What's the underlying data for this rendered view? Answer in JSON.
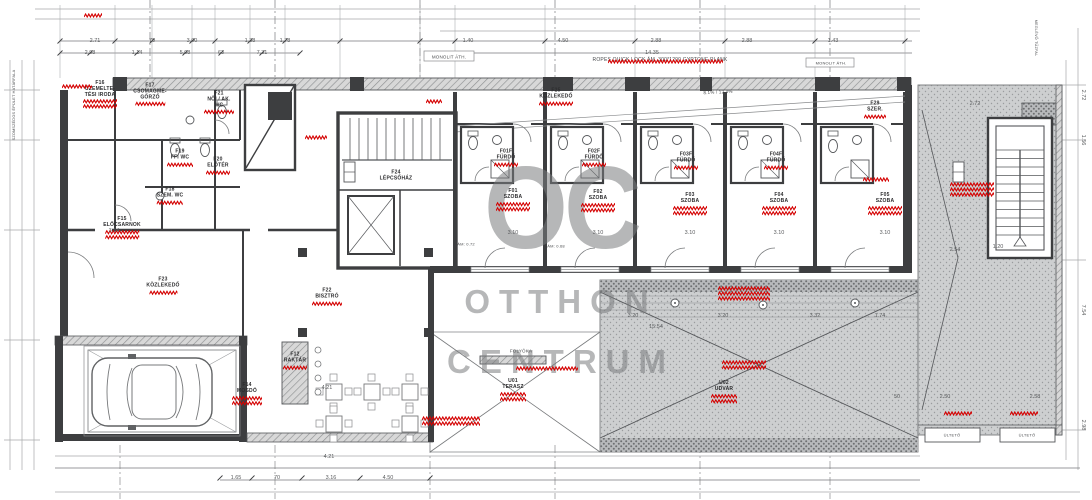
{
  "watermark": {
    "initials": "OC",
    "line1": "OTTHON",
    "line2": "CENTRUM"
  },
  "colors": {
    "wall": "#3d3e40",
    "line_medium": "#77797b",
    "line_light": "#a6a8aa",
    "redaction": "#d40000",
    "hatch_gray": "#d8d8d8",
    "stipple_gray": "#cdcfd0",
    "watermark_gray": "#7a7c7e"
  },
  "notes": [
    {
      "text": "MONOLIT ÁTH.",
      "x": 449,
      "y": 57,
      "size": 4.5,
      "rot": 0
    },
    {
      "text": "ROPES QUICK LOCK ÁM. 300*1200 GYPTONE PLANK",
      "x": 660,
      "y": 60,
      "size": 5,
      "rot": 0
    },
    {
      "text": "MONOLIT ÁTH.",
      "x": 831,
      "y": 63,
      "size": 4,
      "rot": 0
    },
    {
      "text": "8.1% / 12.4%",
      "x": 718,
      "y": 92,
      "size": 4.5,
      "rot": -3
    },
    {
      "text": "FOLYÓKA",
      "x": 521,
      "y": 351,
      "size": 4.5,
      "rot": 0
    },
    {
      "text": "ÜLTETŐ",
      "x": 952,
      "y": 435,
      "size": 4,
      "rot": 0
    },
    {
      "text": "ÜLTETŐ",
      "x": 1027,
      "y": 435,
      "size": 4,
      "rot": 0
    },
    {
      "text": "ÁM: 0.72",
      "x": 466,
      "y": 244,
      "size": 4,
      "rot": 0
    },
    {
      "text": "ÁM: 0.68",
      "x": 556,
      "y": 246,
      "size": 4,
      "rot": 0
    },
    {
      "text": "SZOMSZÉDOS ÉPÜLET HATÁRFALA",
      "x": 14,
      "y": 105,
      "size": 3.8,
      "rot": -90
    },
    {
      "text": "MEGLÉVŐ TŰZFAL",
      "x": 1036,
      "y": 38,
      "size": 3.8,
      "rot": 90
    }
  ],
  "rooms": [
    {
      "lines": [
        "F16",
        "ÜZEMELTE-",
        "TÉSI IRODA"
      ],
      "x": 100,
      "y": 95,
      "red": [
        34,
        2
      ]
    },
    {
      "lines": [
        "F17",
        "CSOMAGME-",
        "GŐRZŐ"
      ],
      "x": 150,
      "y": 95,
      "red": [
        30,
        1
      ]
    },
    {
      "lines": [
        "F21",
        "NŐI / AK.",
        "WC"
      ],
      "x": 219,
      "y": 103,
      "red": [
        30,
        1
      ]
    },
    {
      "lines": [
        "F19",
        "FFI WC"
      ],
      "x": 180,
      "y": 158,
      "red": [
        26,
        1
      ]
    },
    {
      "lines": [
        "F20",
        "ELŐTÉR"
      ],
      "x": 218,
      "y": 166,
      "red": [
        24,
        1
      ]
    },
    {
      "lines": [
        "F18",
        "SZEM. WC"
      ],
      "x": 170,
      "y": 196,
      "red": [
        26,
        1
      ]
    },
    {
      "lines": [
        "F15",
        "ELŐCSARNOK"
      ],
      "x": 122,
      "y": 228,
      "red": [
        34,
        2
      ]
    },
    {
      "lines": [
        "F23",
        "KÖZLEKEDŐ"
      ],
      "x": 163,
      "y": 286,
      "red": [
        28,
        1
      ]
    },
    {
      "lines": [
        "F22",
        "BISZTRÓ"
      ],
      "x": 327,
      "y": 297,
      "red": [
        30,
        1
      ]
    },
    {
      "lines": [
        "F12",
        "RAKTÁR"
      ],
      "x": 295,
      "y": 361,
      "red": [
        24,
        1
      ]
    },
    {
      "lines": [
        "F14",
        "MOSDÓ"
      ],
      "x": 247,
      "y": 394,
      "red": [
        30,
        2
      ]
    },
    {
      "lines": [
        "F24",
        "LÉPCSŐHÁZ"
      ],
      "x": 396,
      "y": 176,
      "red": null
    },
    {
      "lines": [
        "F25",
        "KÖZLEKEDŐ"
      ],
      "x": 556,
      "y": 97,
      "red": [
        34,
        1
      ]
    },
    {
      "lines": [
        "F29",
        "SZER."
      ],
      "x": 875,
      "y": 110,
      "red": [
        22,
        1
      ]
    },
    {
      "lines": [
        "F01F",
        "FÜRDŐ"
      ],
      "x": 506,
      "y": 158,
      "red": [
        24,
        1
      ]
    },
    {
      "lines": [
        "F02F",
        "FÜRDŐ"
      ],
      "x": 594,
      "y": 158,
      "red": [
        24,
        1
      ]
    },
    {
      "lines": [
        "F03F",
        "FÜRDŐ"
      ],
      "x": 686,
      "y": 161,
      "red": [
        24,
        1
      ]
    },
    {
      "lines": [
        "F04F",
        "FÜRDŐ"
      ],
      "x": 776,
      "y": 161,
      "red": [
        24,
        1
      ]
    },
    {
      "lines": [
        "F01",
        "SZOBA"
      ],
      "x": 513,
      "y": 200,
      "red": [
        34,
        2
      ]
    },
    {
      "lines": [
        "F02",
        "SZOBA"
      ],
      "x": 598,
      "y": 201,
      "red": [
        34,
        2
      ]
    },
    {
      "lines": [
        "F03",
        "SZOBA"
      ],
      "x": 690,
      "y": 204,
      "red": [
        34,
        2
      ]
    },
    {
      "lines": [
        "F04",
        "SZOBA"
      ],
      "x": 779,
      "y": 204,
      "red": [
        34,
        2
      ]
    },
    {
      "lines": [
        "F05",
        "SZOBA"
      ],
      "x": 885,
      "y": 204,
      "red": [
        34,
        2
      ]
    },
    {
      "lines": [
        "U01",
        "TERASZ"
      ],
      "x": 513,
      "y": 390,
      "red": [
        26,
        2
      ]
    },
    {
      "lines": [
        "U02",
        "UDVAR"
      ],
      "x": 724,
      "y": 392,
      "red": [
        26,
        2
      ]
    }
  ],
  "dims": [
    {
      "t": "2.71",
      "x": 95,
      "y": 41
    },
    {
      "t": "70",
      "x": 152,
      "y": 41
    },
    {
      "t": "3.00",
      "x": 192,
      "y": 41
    },
    {
      "t": "1.38",
      "x": 250,
      "y": 41
    },
    {
      "t": "1.78",
      "x": 285,
      "y": 41
    },
    {
      "t": "1.40",
      "x": 468,
      "y": 41
    },
    {
      "t": "4.50",
      "x": 563,
      "y": 41
    },
    {
      "t": "2.88",
      "x": 656,
      "y": 41
    },
    {
      "t": "2.88",
      "x": 747,
      "y": 41
    },
    {
      "t": "1.43",
      "x": 833,
      "y": 41
    },
    {
      "t": "2.98",
      "x": 90,
      "y": 53
    },
    {
      "t": "1.14",
      "x": 137,
      "y": 53
    },
    {
      "t": "5.08",
      "x": 185,
      "y": 53
    },
    {
      "t": "63",
      "x": 221,
      "y": 53
    },
    {
      "t": "7.31",
      "x": 262,
      "y": 53
    },
    {
      "t": "14.35",
      "x": 652,
      "y": 53
    },
    {
      "t": "3.14",
      "x": 114,
      "y": 231
    },
    {
      "t": "3.10",
      "x": 513,
      "y": 233
    },
    {
      "t": "3.10",
      "x": 598,
      "y": 233
    },
    {
      "t": "3.10",
      "x": 690,
      "y": 233
    },
    {
      "t": "3.10",
      "x": 779,
      "y": 233
    },
    {
      "t": "3.10",
      "x": 885,
      "y": 233
    },
    {
      "t": "3.20",
      "x": 633,
      "y": 316
    },
    {
      "t": "3.20",
      "x": 723,
      "y": 316
    },
    {
      "t": "3.32",
      "x": 815,
      "y": 316
    },
    {
      "t": "1.74",
      "x": 880,
      "y": 316
    },
    {
      "t": "15.54",
      "x": 656,
      "y": 327
    },
    {
      "t": "4.21",
      "x": 327,
      "y": 388
    },
    {
      "t": "4.21",
      "x": 329,
      "y": 457
    },
    {
      "t": "2.72",
      "x": 975,
      "y": 104
    },
    {
      "t": "1.20",
      "x": 998,
      "y": 247
    },
    {
      "t": "2.54",
      "x": 955,
      "y": 250
    },
    {
      "t": "50",
      "x": 897,
      "y": 397
    },
    {
      "t": "2.50",
      "x": 945,
      "y": 397
    },
    {
      "t": "2.58",
      "x": 1035,
      "y": 397
    },
    {
      "t": "1.65",
      "x": 236,
      "y": 478
    },
    {
      "t": "70",
      "x": 277,
      "y": 478
    },
    {
      "t": "3.16",
      "x": 331,
      "y": 478
    },
    {
      "t": "4.50",
      "x": 388,
      "y": 478
    },
    {
      "t": "2.72",
      "x": 1083,
      "y": 95,
      "rot": 90
    },
    {
      "t": "1.56",
      "x": 1083,
      "y": 140,
      "rot": 90
    },
    {
      "t": "7.54",
      "x": 1083,
      "y": 310,
      "rot": 90
    },
    {
      "t": "2.98",
      "x": 1083,
      "y": 425,
      "rot": 90
    }
  ],
  "redactions": [
    {
      "x": 84,
      "y": 13,
      "w": 18,
      "rows": 1
    },
    {
      "x": 62,
      "y": 84,
      "w": 30,
      "rows": 1
    },
    {
      "x": 608,
      "y": 59,
      "w": 115,
      "rows": 1
    },
    {
      "x": 426,
      "y": 99,
      "w": 16,
      "rows": 1
    },
    {
      "x": 305,
      "y": 135,
      "w": 22,
      "rows": 1
    },
    {
      "x": 718,
      "y": 286,
      "w": 52,
      "rows": 3
    },
    {
      "x": 722,
      "y": 360,
      "w": 44,
      "rows": 2
    },
    {
      "x": 516,
      "y": 366,
      "w": 62,
      "rows": 1
    },
    {
      "x": 422,
      "y": 416,
      "w": 58,
      "rows": 2
    },
    {
      "x": 950,
      "y": 182,
      "w": 44,
      "rows": 3
    },
    {
      "x": 944,
      "y": 411,
      "w": 28,
      "rows": 1
    },
    {
      "x": 1010,
      "y": 411,
      "w": 28,
      "rows": 1
    },
    {
      "x": 863,
      "y": 177,
      "w": 26,
      "rows": 1
    }
  ]
}
